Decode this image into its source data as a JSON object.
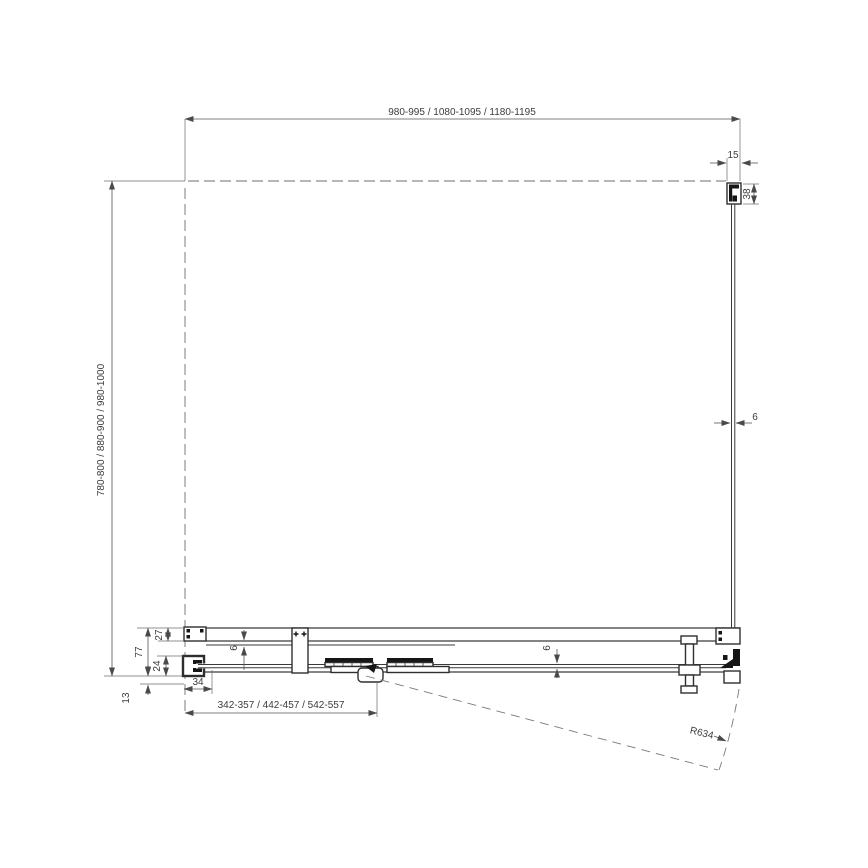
{
  "drawing": {
    "title": "shower-corner-enclosure-plan-view",
    "colors": {
      "line": "#3a3a3a",
      "dim": "#555555",
      "background": "#ffffff"
    },
    "dimensions": {
      "top_width": "980-995 / 1080-1095 / 1180-1195",
      "side_depth": "780-800 / 880-900 / 980-1000",
      "door_entry_span": "342-357 / 442-457 / 542-557",
      "wall_profile_width": "15",
      "wall_profile_depth": "38",
      "side_glass_thickness": "6",
      "fixed_glass_thickness": "6",
      "door_glass_thickness": "6",
      "assembly_depth": "77",
      "top_rail_depth": "27",
      "door_profile_depth": "24",
      "threshold_offset": "13",
      "end_profile_width": "34",
      "swing_radius": "R634"
    }
  }
}
